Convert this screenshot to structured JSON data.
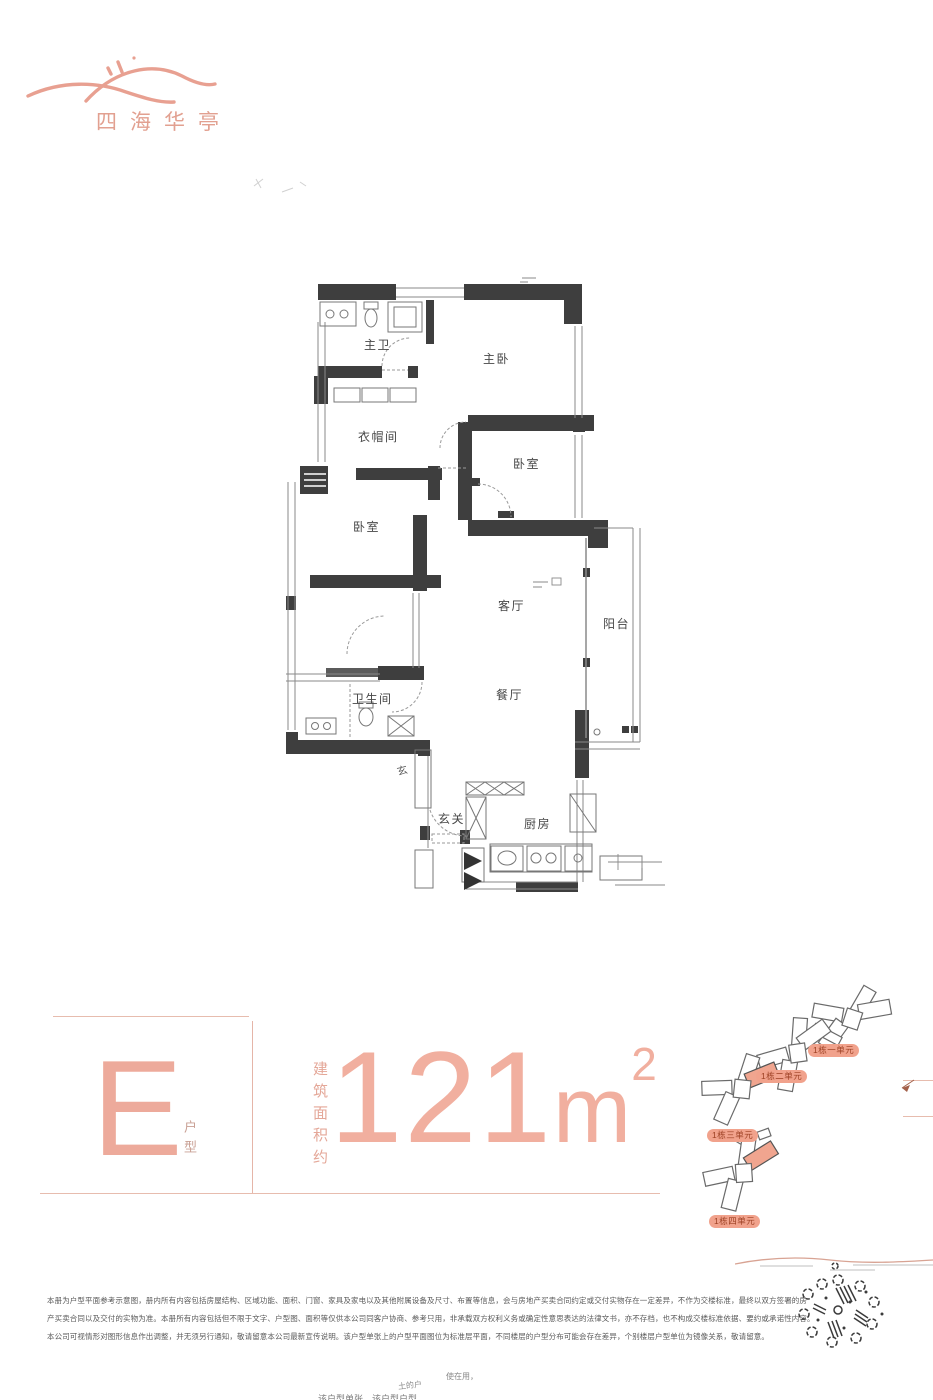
{
  "brand": {
    "name": "四海华亭"
  },
  "floor_plan": {
    "rooms": {
      "master_bath": "主卫",
      "master_bed": "主卧",
      "cloak": "衣帽间",
      "bed_right": "卧室",
      "bed_left": "卧室",
      "living": "客厅",
      "balcony": "阳台",
      "dining": "餐厅",
      "bath": "卫生间",
      "hall": "玄",
      "foyer": "玄关",
      "kitchen": "厨房"
    }
  },
  "spec": {
    "unit_letter": "E",
    "unit_suffix": "户型",
    "area_label": "建筑面积约",
    "area_value": "121",
    "area_unit": "m",
    "area_exponent": "2"
  },
  "site_map": {
    "labels": [
      "1栋一单元",
      "1栋二单元",
      "1栋三单元",
      "1栋四单元"
    ]
  },
  "disclaimer": {
    "lines": [
      "本册为户型平面参考示意图，册内所有内容包括房屋结构、区域功能、面积、门窗、家具及家电以及其他附属设备及尺寸、布置等信息，会与房地产买卖合同约定或交付实物存在一定差异，不作为交楼标准，最终以双方签署的房",
      "产买卖合同以及交付的实物为准。本册所有内容包括但不限于文字、户型图、面积等仅供本公司同客户协商、参考只用，非承载双方权利义务或确定性意思表达的法律文书，亦不存档，也不构成交楼标准依据、要约或承诺性内容。",
      "本公司可视情形对图形信息作出调整，并无须另行通知，敬请留意本公司最新宣传说明。该户型单张上的户型平面图位为标准层平面，不同楼层的户型分布可能会存在差异，个别楼层户型单位为镜像关系，敬请留意。"
    ]
  },
  "footer": {
    "fragments": [
      "土的户",
      "使在用，",
      "该户型单张　该户型户型"
    ]
  },
  "colors": {
    "accent": "#e8a091",
    "area_text": "#f1af9f",
    "badge_bg": "#f1a28c",
    "badge_text": "#9c3f22",
    "wall": "#3e3e3e"
  }
}
